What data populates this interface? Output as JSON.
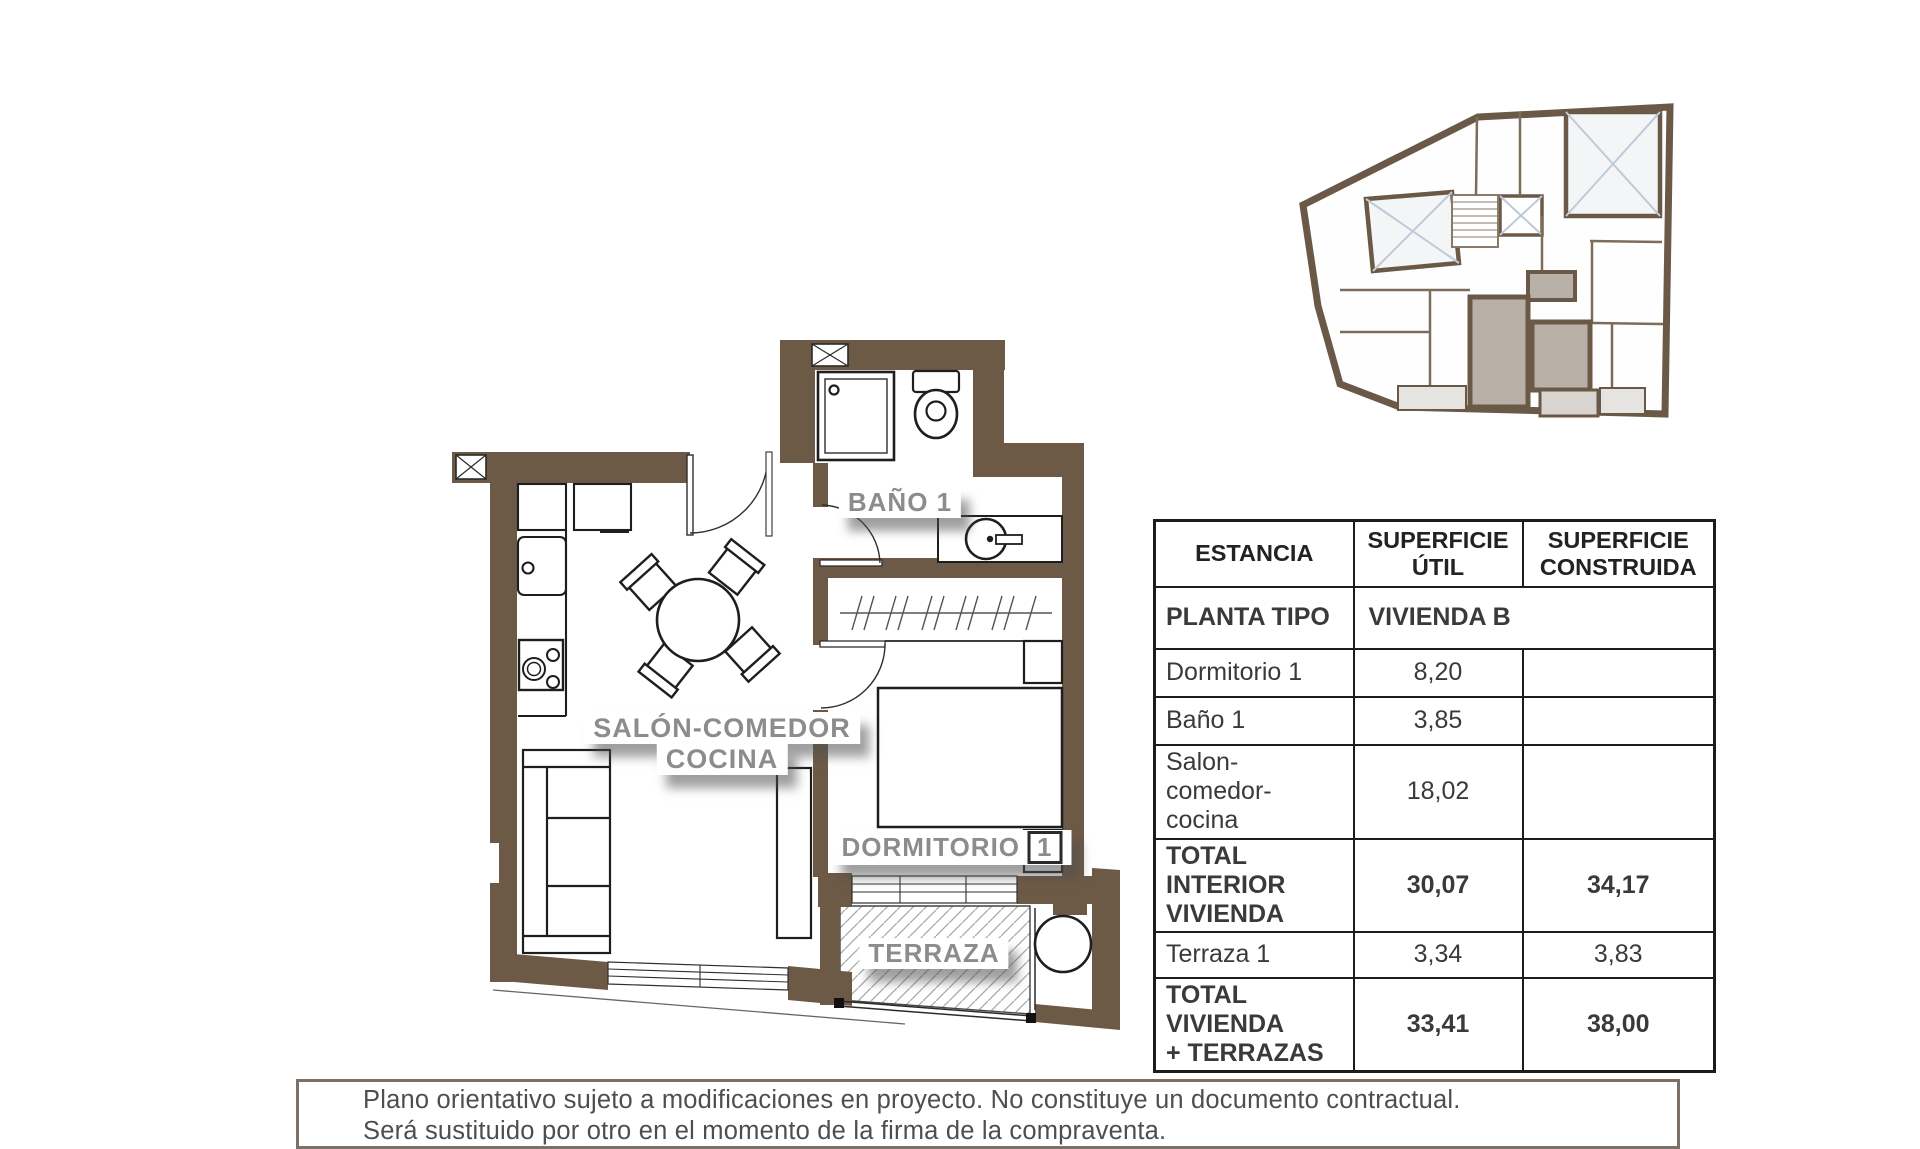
{
  "plan": {
    "labels": {
      "bano": "BAÑO 1",
      "salon_line1": "SALÓN-COMEDOR",
      "salon_line2": "COCINA",
      "dormitorio_word": "DORMITORIO",
      "dormitorio_num": "1",
      "terraza": "TERRAZA"
    },
    "colors": {
      "wall_brown": "#6d5a46",
      "keyplan_unit_highlight": "#b9b0a7",
      "label_gray": "#8c8c8c",
      "patio_cross_blue": "#bfcad8"
    }
  },
  "table": {
    "headers": {
      "estancia": "ESTANCIA",
      "util_line1": "SUPERFICIE",
      "util_line2": "ÚTIL",
      "construida_line1": "SUPERFICIE",
      "construida_line2": "CONSTRUIDA"
    },
    "planta": {
      "label": "PLANTA TIPO",
      "value": "VIVIENDA B"
    },
    "rows": [
      {
        "name": "Dormitorio 1",
        "util": "8,20",
        "construida": ""
      },
      {
        "name": "Baño 1",
        "util": "3,85",
        "construida": ""
      },
      {
        "name_lines": [
          "Salon-",
          "comedor-",
          "cocina"
        ],
        "util": "18,02",
        "construida": ""
      },
      {
        "name_lines2": [
          "TOTAL INTERIOR",
          "VIVIENDA"
        ],
        "util": "30,07",
        "construida": "34,17"
      },
      {
        "name": "Terraza 1",
        "util": "3,34",
        "construida": "3,83"
      },
      {
        "name_lines2": [
          "TOTAL VIVIENDA",
          "+ TERRAZAS"
        ],
        "util": "33,41",
        "construida": "38,00"
      }
    ]
  },
  "disclaimer": {
    "line1": "Plano orientativo sujeto a modificaciones en proyecto. No constituye un documento contractual.",
    "line2": "Será sustituido por otro en el momento de la firma de la compraventa."
  }
}
